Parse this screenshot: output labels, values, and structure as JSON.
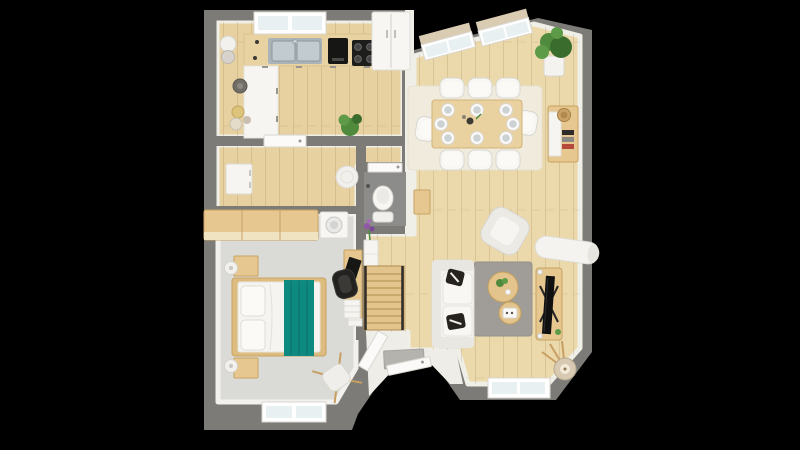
{
  "scene": {
    "kind": "3d-floor-plan-top-view",
    "background": "#000000"
  },
  "colors": {
    "background": "#000000",
    "wall": "#7c7b77",
    "wallInner": "#efeee7",
    "woodLiving": "#ecd9ab",
    "woodKitchen": "#e7d1a0",
    "stairsWood": "#e2c48c",
    "stairsEdge": "#b08c4f",
    "bedroomFloor": "#dadad6",
    "bedroomWall": "#f2f1ee",
    "entryFloor": "#efede7",
    "wcFloor": "#8c8c8a",
    "rugDining": "#f0ebdc",
    "rugLiving": "#a09d98",
    "sofaWhite": "#f3f2ee",
    "cushionWhite": "#f8f7f4",
    "sofaShade": "#e9e7e1",
    "pillowDark": "#26231f",
    "teal": "#0f8a80",
    "tealDark": "#0c7169",
    "furnitureWood": "#e5c78f",
    "furnitureWoodEdge": "#c9a363",
    "tableWood": "#ead1a0",
    "bedFrame": "#ddbc7f",
    "counterWood": "#e9d2a2",
    "cabinetWhite": "#f6f5f1",
    "applianceBlack": "#161614",
    "cooktopBlack": "#1d1d1b",
    "sinkSteel": "#aab3b8",
    "sinkBasin": "#c2cbd0",
    "glass": "#e9f0f2",
    "windowFrame": "#ffffff",
    "frameEdge": "#d9d7d1",
    "doorWhite": "#fbfaf8",
    "mat": "#b5b3ae",
    "lampShade": "#d8c9b2",
    "lampInner": "#f3ead8",
    "plantGreen": "#4f8a3d",
    "plantLight": "#5d9b49",
    "plantDark": "#3a6c2d",
    "flowerPurple": "#9355a8",
    "whiteGoods": "#f7f6f3",
    "sillBeige": "#d9ccb3",
    "blackRail": "#2f2d2a",
    "chairBlack": "#232220",
    "potGray": "#716d67",
    "bowlYellow": "#dec37a",
    "bowlCream": "#e4dbc9",
    "basketTan": "#c9a369",
    "bookRed": "#b5493c",
    "legWood": "#c79f63"
  },
  "rooms": {
    "kitchen": {
      "items": [
        "l-shaped-counter",
        "double-sink",
        "faucet",
        "coffee-machine",
        "cooktop",
        "fridge",
        "open-shelf-decor",
        "potted-plant",
        "window",
        "door-to-hallway"
      ]
    },
    "hallway": {
      "items": [
        "dresser",
        "pouf"
      ]
    },
    "wc": {
      "items": [
        "toilet",
        "toilet-paper-holder",
        "door",
        "side-cabinet"
      ]
    },
    "bedroom": {
      "items": [
        "double-bed",
        "teal-throw",
        "nightstand",
        "nightstand",
        "ball-lamp",
        "ball-lamp",
        "wardrobe",
        "washing-machine",
        "desk",
        "laptop",
        "office-chair",
        "side-chair",
        "paper-stack",
        "window",
        "window"
      ]
    },
    "dining_area": {
      "items": [
        "dining-table",
        "chair",
        "chair",
        "chair",
        "chair",
        "chair",
        "chair",
        "chair",
        "chair",
        "place-setting-x8",
        "cream-rug",
        "sideboard",
        "basket",
        "books",
        "potted-plant",
        "slanted-window",
        "slanted-window"
      ]
    },
    "living_area": {
      "items": [
        "sofa",
        "dark-pillow",
        "dark-pillow",
        "armchair",
        "gray-rug",
        "round-coffee-table-large",
        "round-coffee-table-small",
        "tv-stand",
        "tv",
        "floor-lamp",
        "white-bench",
        "console-with-flowers",
        "window",
        "window"
      ]
    },
    "stairs": {
      "items": [
        "staircase",
        "handrail",
        "handrail",
        "under-stair-storage"
      ]
    },
    "entry": {
      "items": [
        "front-door",
        "doormat",
        "bedroom-door"
      ]
    }
  },
  "counts": {
    "dining_chairs": 8,
    "place_settings": 8,
    "bedroom_windows": 2,
    "living_windows": 2,
    "dining_windows": 2
  }
}
